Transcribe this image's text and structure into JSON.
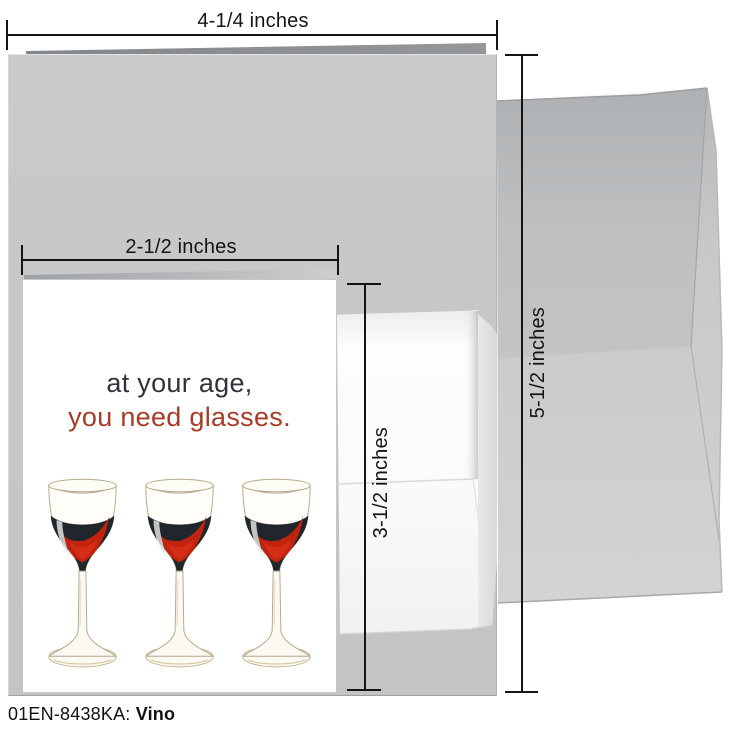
{
  "product": {
    "code": "01EN-8438KA:",
    "name": "Vino"
  },
  "measurements": {
    "large_card_width": "4-1/4 inches",
    "large_card_height": "5-1/2 inches",
    "small_card_width": "2-1/2 inches",
    "small_card_height": "3-1/2 inches"
  },
  "small_card": {
    "message_line1": "at your age,",
    "message_line2": "you need glasses.",
    "glass_count": 3
  },
  "colors": {
    "measure": "#141414",
    "message_line1": "#30343a",
    "message_line2": "#a63c28",
    "large_card": "#c5c7c9",
    "large_card_edge": "#8c8f92",
    "large_envelope": "#c6c8ca",
    "small_envelope": "#f7f7f8",
    "small_card_face": "#ffffff",
    "wine_dark": "#20262b",
    "wine_red": "#c1230f",
    "glass_outline": "#b3a88c"
  }
}
